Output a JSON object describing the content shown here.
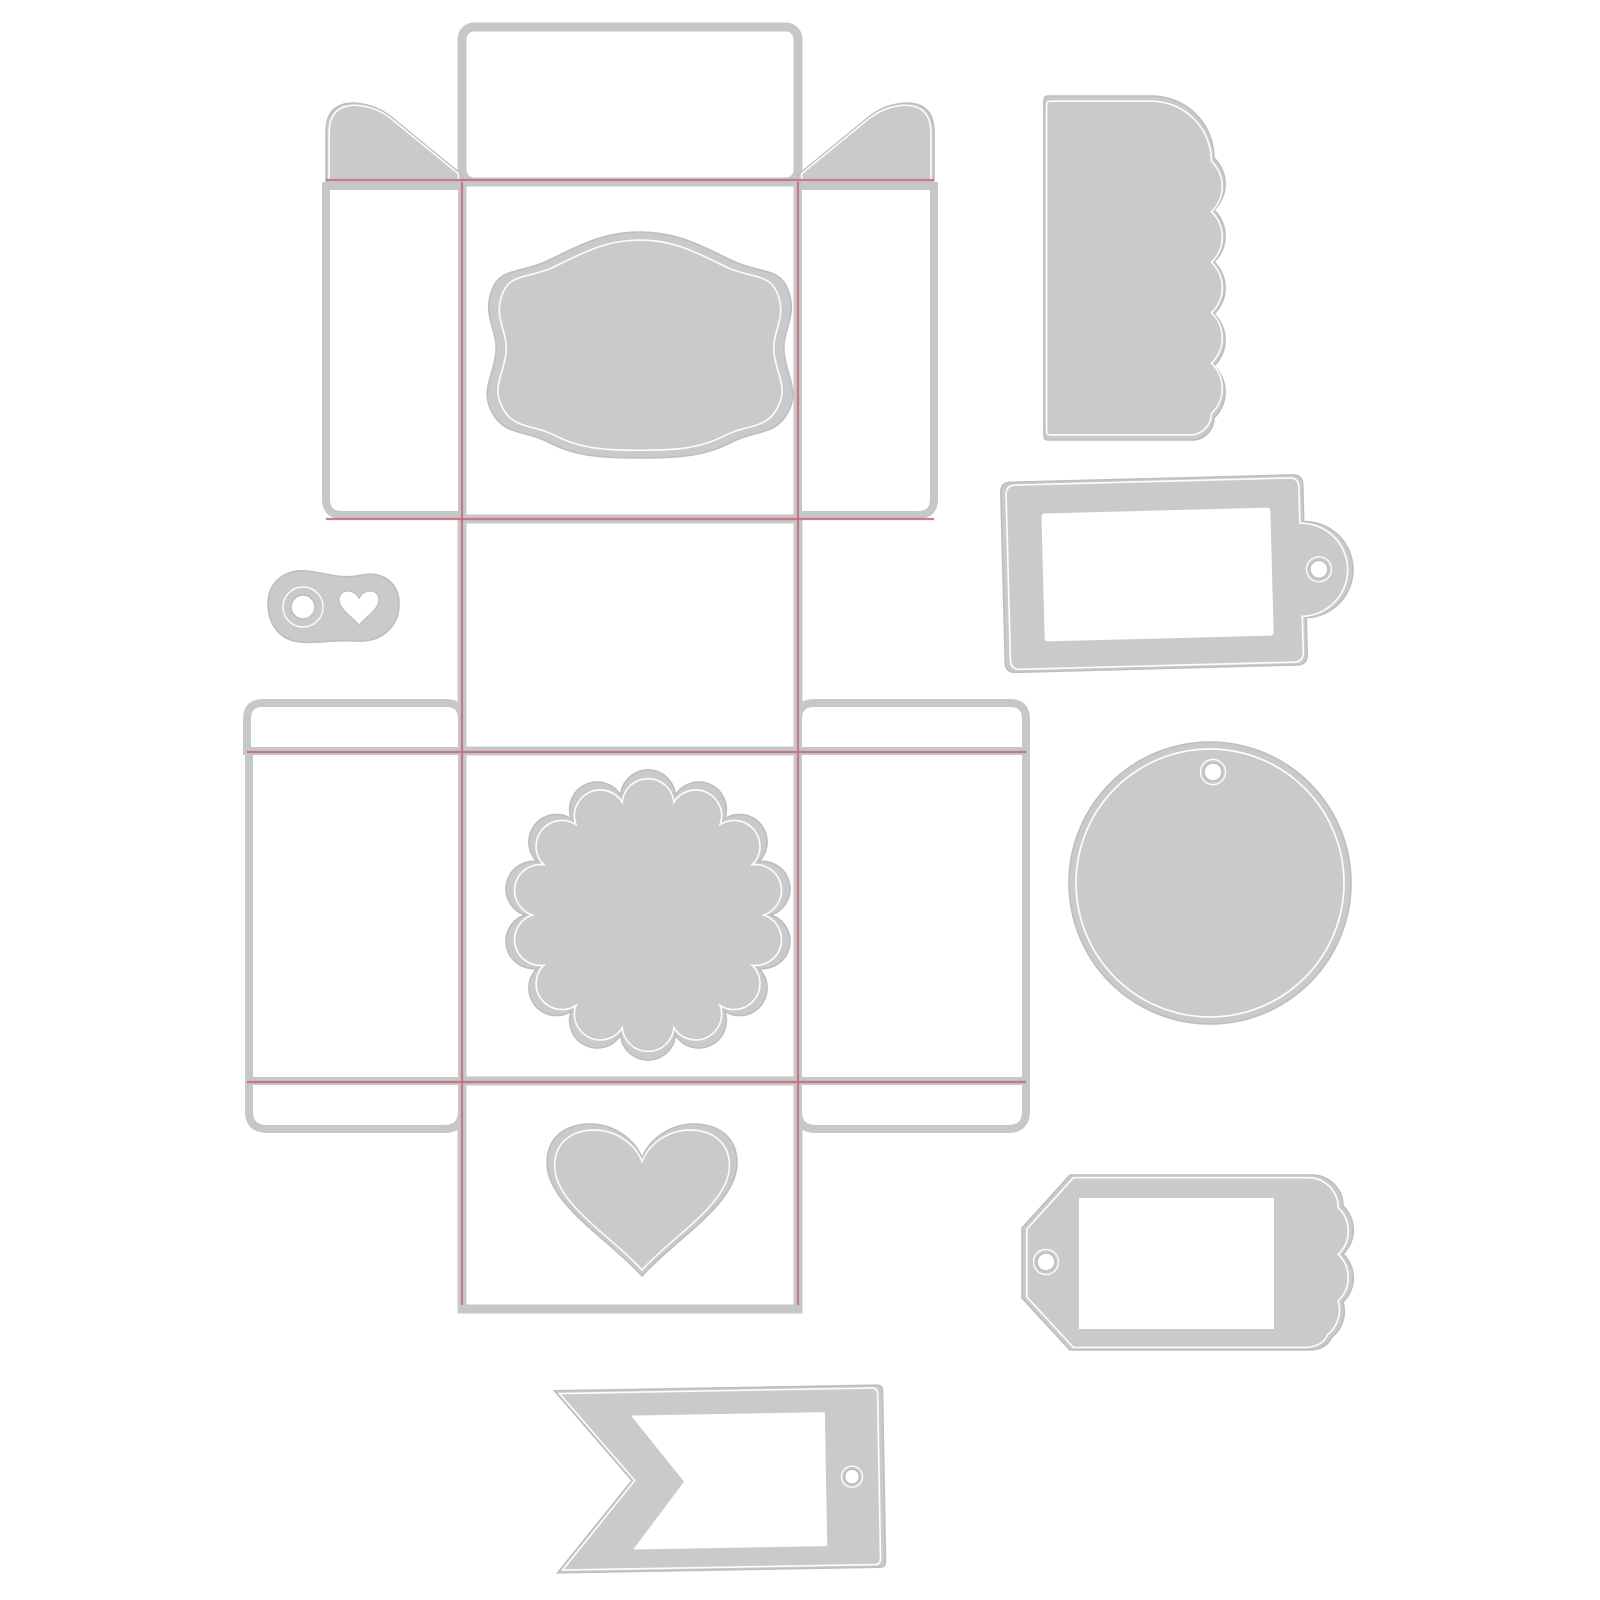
{
  "page": {
    "title": "Die-cut template sheet",
    "background": "#ffffff"
  },
  "colors": {
    "background": "#ffffff",
    "die_fill": "#c9cacc",
    "die_edge": "#bdbec0",
    "panel_edge": "#c6c7c9",
    "hairline": "#ffffff",
    "fold_line": "#c96f7b"
  },
  "pieces": {
    "box_template": {
      "label": "Gift box die template with red fold lines"
    },
    "top_flap": {
      "label": "Box top flap panel"
    },
    "corner_flaps": {
      "label": "Angled corner glue flaps"
    },
    "side_flaps": {
      "label": "Box side flap panels"
    },
    "ornate_label": {
      "label": "Ornate bracket label die"
    },
    "scalloped_circle": {
      "label": "Scalloped circle die"
    },
    "heart": {
      "label": "Heart die"
    },
    "eyelet_trim": {
      "label": "Eyelet and heart trim die"
    },
    "scalloped_edge_tag": {
      "label": "Scalloped edge tag die"
    },
    "frame_label_tag": {
      "label": "Frame label tag die with string hole"
    },
    "circle_tag": {
      "label": "Circle tag die with string hole"
    },
    "luggage_tag": {
      "label": "Luggage tag die with scalloped end and window"
    },
    "flag_banner": {
      "label": "Swallowtail flag banner die with window"
    }
  }
}
